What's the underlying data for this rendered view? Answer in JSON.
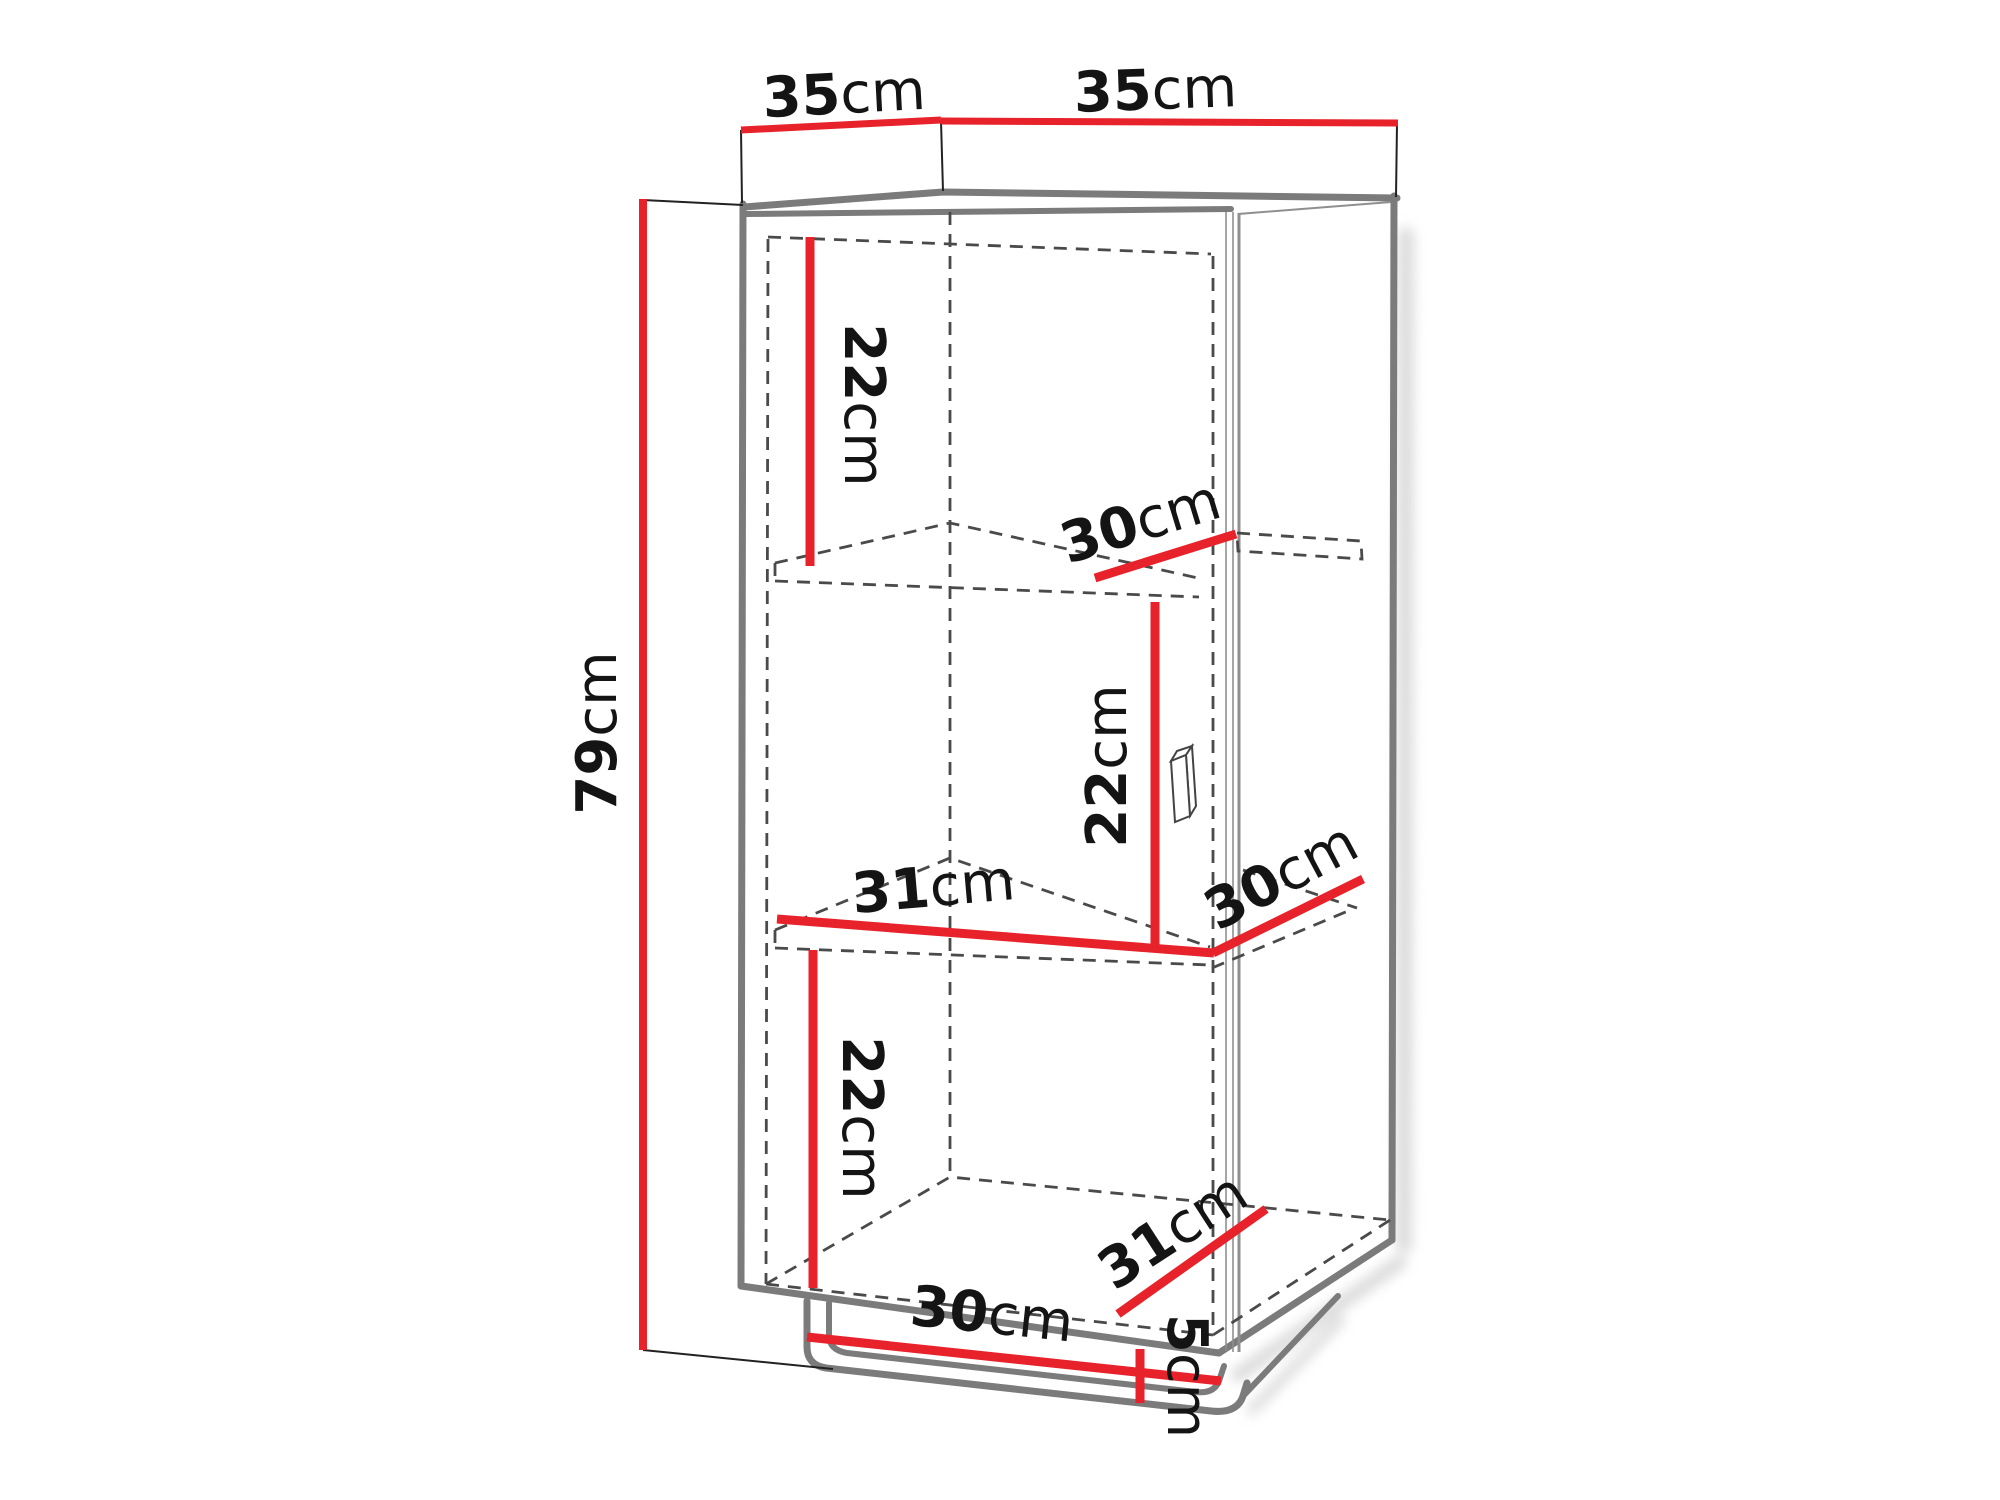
{
  "title": "Cabinet technical dimension diagram",
  "colors": {
    "dimension_red": "#e8222b",
    "outline_gray": "#7b7b7b",
    "dashed_gray": "#4a4a4a",
    "text_black": "#141414",
    "background": "#ffffff"
  },
  "dimensions": {
    "top_depth": {
      "value": "35",
      "unit": "cm"
    },
    "top_width": {
      "value": "35",
      "unit": "cm"
    },
    "height": {
      "value": "79",
      "unit": "cm"
    },
    "upper_compartment_height": {
      "value": "22",
      "unit": "cm"
    },
    "upper_shelf_depth": {
      "value": "30",
      "unit": "cm"
    },
    "middle_compartment_height": {
      "value": "22",
      "unit": "cm"
    },
    "middle_shelf_width": {
      "value": "31",
      "unit": "cm"
    },
    "middle_shelf_depth": {
      "value": "30",
      "unit": "cm"
    },
    "lower_compartment_height": {
      "value": "22",
      "unit": "cm"
    },
    "bottom_depth": {
      "value": "31",
      "unit": "cm"
    },
    "bottom_width": {
      "value": "30",
      "unit": "cm"
    },
    "plinth_height": {
      "value": "5",
      "unit": "cm"
    }
  }
}
